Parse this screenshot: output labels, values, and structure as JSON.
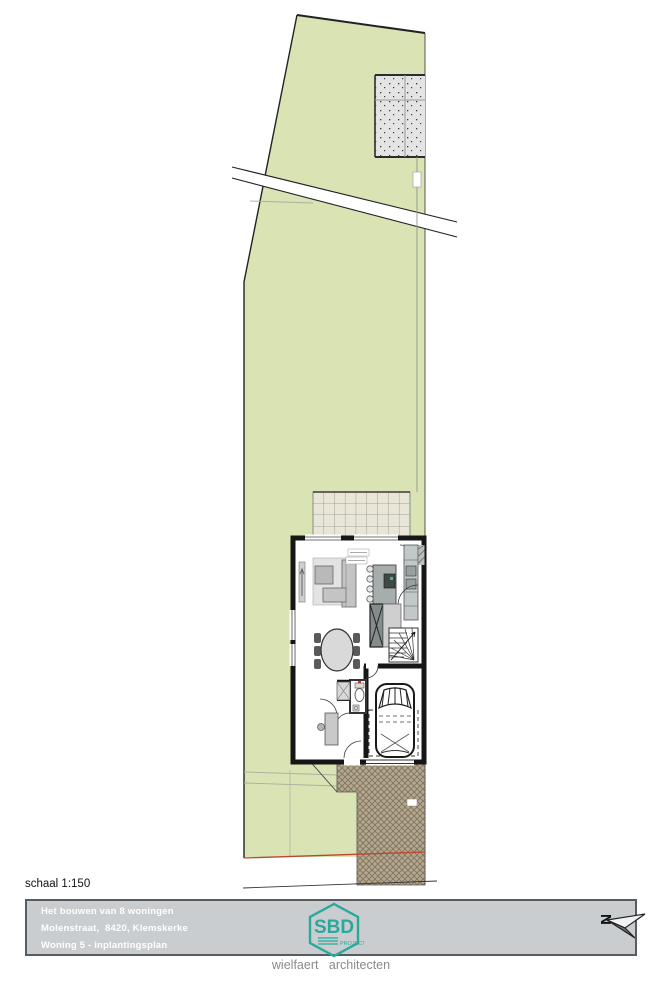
{
  "scale_label": "schaal 1:150",
  "title_block": {
    "line1": "Het bouwen van 8 woningen",
    "line2": "Molenstraat,  8420, Klemskerke",
    "line3": "Woning 5 - inplantingsplan"
  },
  "logo": {
    "text": "SBD",
    "subtext": "PROJECT"
  },
  "north_label": "N",
  "footer": "wielfaert architecten",
  "colors": {
    "plot_green": "#d9e3b4",
    "terrace_tile": "#eae6d7",
    "driveway_tan": "#b5a78e",
    "stipple_gray": "#e4e4e4",
    "title_bar_bg": "#c9cdd0",
    "brand_teal": "#2ba89c",
    "boundary_red": "#c0442e",
    "wall_black": "#161616"
  }
}
